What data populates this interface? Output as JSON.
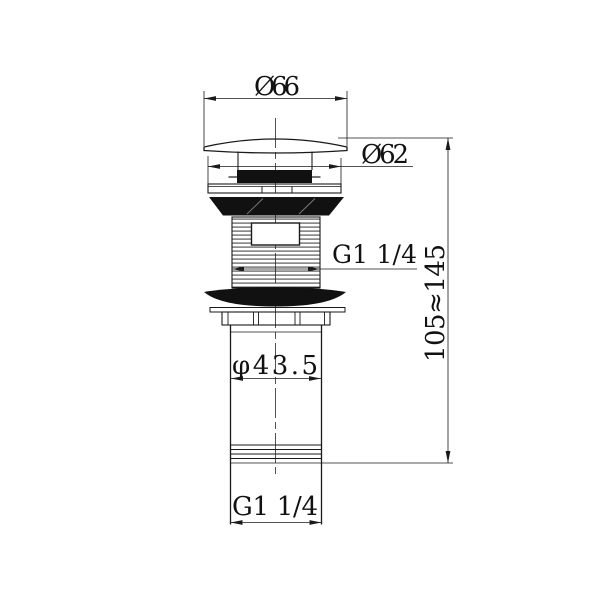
{
  "drawing": {
    "kind": "pop-up-drain-technical-drawing",
    "background": "#ffffff",
    "line_color": "#1a1a1a",
    "labels": {
      "cap_diameter": "Ø66",
      "flange_diameter": "Ø62",
      "body_thread": "G1 1/4",
      "tube_diameter": "φ43.5",
      "overall_height": "105≈145",
      "tail_thread": "G1 1/4"
    }
  }
}
